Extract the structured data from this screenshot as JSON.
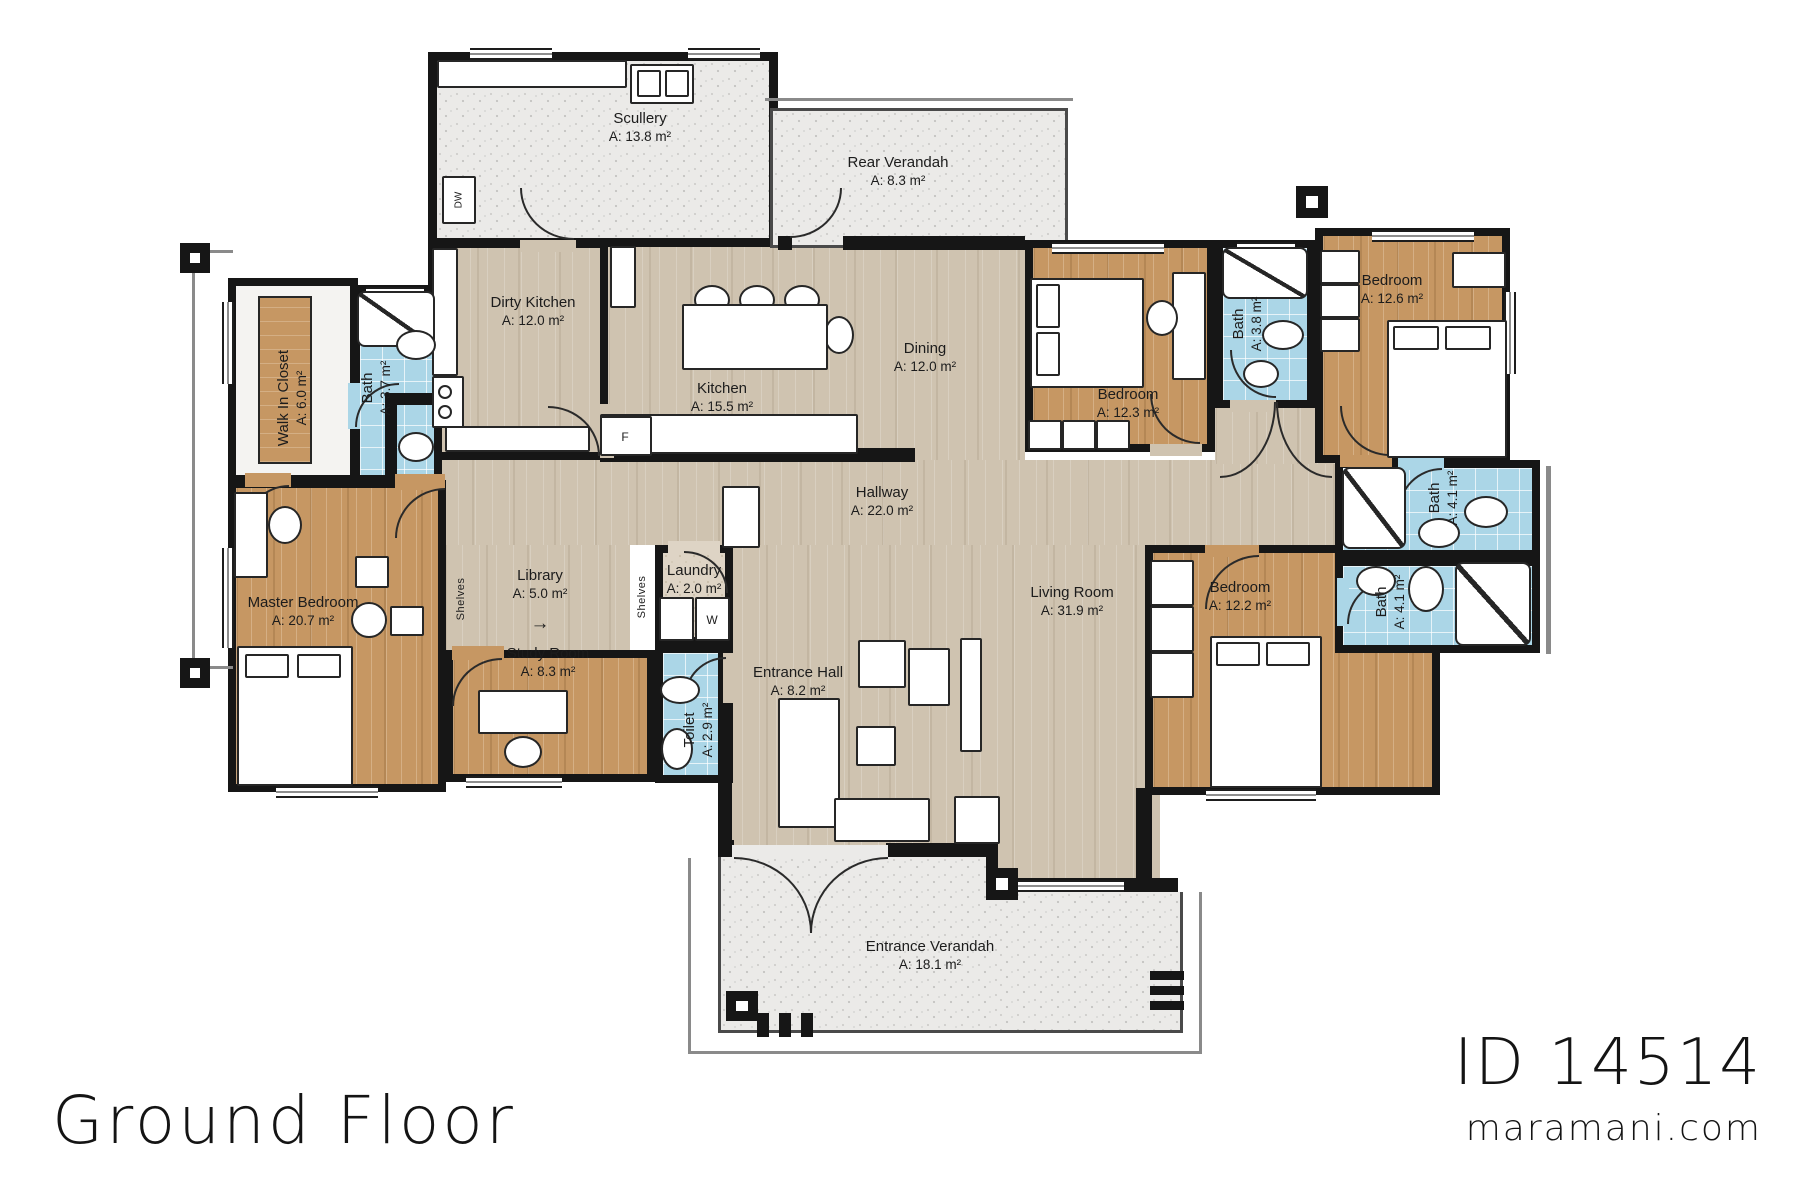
{
  "plan": {
    "floor_title": "Ground Floor",
    "plan_id": "ID 14514",
    "website": "maramani.com",
    "rooms": {
      "scullery": {
        "name": "Scullery",
        "area": "A: 13.8 m²"
      },
      "rear_verandah": {
        "name": "Rear Verandah",
        "area": "A: 8.3 m²"
      },
      "dirty_kitchen": {
        "name": "Dirty Kitchen",
        "area": "A: 12.0 m²"
      },
      "kitchen": {
        "name": "Kitchen",
        "area": "A: 15.5 m²"
      },
      "dining": {
        "name": "Dining",
        "area": "A: 12.0 m²"
      },
      "bedroom_right_top": {
        "name": "Bedroom",
        "area": "A: 12.3 m²"
      },
      "bath_right_top": {
        "name": "Bath",
        "area": "A: 3.8 m²"
      },
      "bedroom_far_right": {
        "name": "Bedroom",
        "area": "A: 12.6 m²"
      },
      "walk_in_closet": {
        "name": "Walk In Closet",
        "area": "A: 6.0 m²"
      },
      "bath_master": {
        "name": "Bath",
        "area": "A: 3.7 m²"
      },
      "master_bedroom": {
        "name": "Master Bedroom",
        "area": "A: 20.7 m²"
      },
      "library": {
        "name": "Library",
        "area": "A: 5.0 m²"
      },
      "laundry": {
        "name": "Laundry",
        "area": "A: 2.0 m²"
      },
      "study_room": {
        "name": "Study Room",
        "area": "A: 8.3 m²"
      },
      "toilet": {
        "name": "Toilet",
        "area": "A: 2.9 m²"
      },
      "hallway": {
        "name": "Hallway",
        "area": "A: 22.0 m²"
      },
      "entrance_hall": {
        "name": "Entrance Hall",
        "area": "A: 8.2 m²"
      },
      "living_room": {
        "name": "Living Room",
        "area": "A: 31.9 m²"
      },
      "bedroom_right_bottom": {
        "name": "Bedroom",
        "area": "A: 12.2 m²"
      },
      "bath_upper_right": {
        "name": "Bath",
        "area": "A: 4.1 m²"
      },
      "bath_lower_right": {
        "name": "Bath",
        "area": "A: 4.1 m²"
      },
      "entrance_verandah": {
        "name": "Entrance Verandah",
        "area": "A: 18.1 m²"
      }
    },
    "fixtures": {
      "dishwasher": "DW",
      "fridge": "F",
      "washer": "W",
      "shelves_left": "Shelves",
      "shelves_right": "Shelves",
      "library_arrow": "→"
    },
    "colors": {
      "wall": "#161616",
      "wood_light": "#cfc3b0",
      "wood_warm": "#c69763",
      "bath_tile": "#abd6e7",
      "verandah_gray": "#ebeae8",
      "laundry_beige": "#ded4c5"
    }
  }
}
